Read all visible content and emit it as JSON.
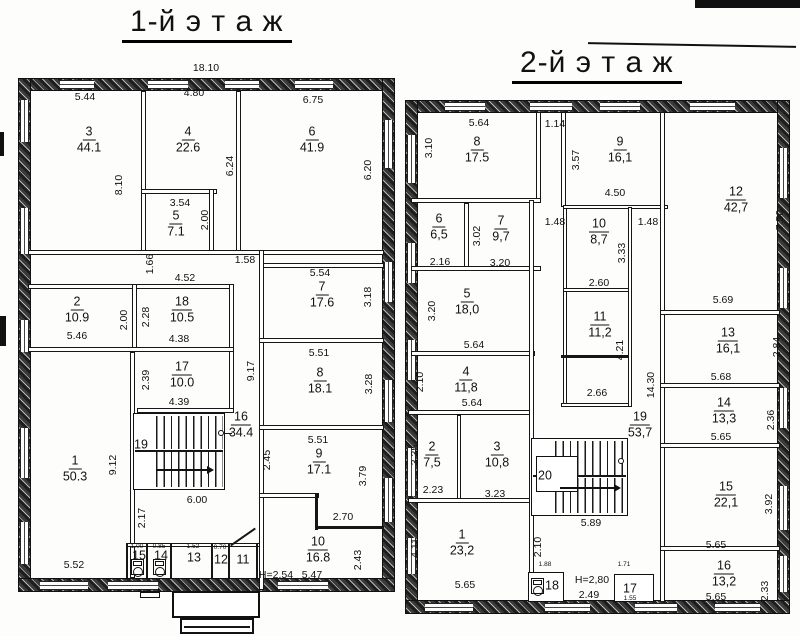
{
  "floor1": {
    "title": "1-й э т а ж",
    "rooms": {
      "r1": {
        "num": "1",
        "area": "50.3"
      },
      "r2": {
        "num": "2",
        "area": "10.9"
      },
      "r3": {
        "num": "3",
        "area": "44.1"
      },
      "r4": {
        "num": "4",
        "area": "22.6"
      },
      "r5": {
        "num": "5",
        "area": "7.1"
      },
      "r6": {
        "num": "6",
        "area": "41.9"
      },
      "r7": {
        "num": "7",
        "area": "17.6"
      },
      "r8": {
        "num": "8",
        "area": "18.1"
      },
      "r9": {
        "num": "9",
        "area": "17.1"
      },
      "r10": {
        "num": "10",
        "area": "16.8"
      },
      "r11": {
        "num": "11"
      },
      "r12": {
        "num": "12"
      },
      "r13": {
        "num": "13"
      },
      "r14": {
        "num": "14"
      },
      "r15": {
        "num": "15"
      },
      "r16": {
        "num": "16",
        "area": "34.4"
      },
      "r17": {
        "num": "17",
        "area": "10.0"
      },
      "r18": {
        "num": "18",
        "area": "10.5"
      },
      "r19": {
        "num": "19"
      }
    },
    "dims": {
      "total": "18.10",
      "a544": "5.44",
      "a480": "4.80",
      "a675": "6.75",
      "a810": "8.10",
      "a624": "6.24",
      "a620": "6.20",
      "a354": "3.54",
      "a200a": "2.00",
      "a166": "1.66",
      "a452": "4.52",
      "a158": "1.58",
      "a554": "5.54",
      "a318": "3.18",
      "a200b": "2.00",
      "a546": "5.46",
      "a228": "2.28",
      "a438": "4.38",
      "a239": "2.39",
      "a439": "4.39",
      "a917": "9.17",
      "a245": "2.45",
      "a551a": "5.51",
      "a328": "3.28",
      "a551b": "5.51",
      "a379": "3.79",
      "a912": "9.12",
      "a217": "2.17",
      "a600": "6.00",
      "a270": "2.70",
      "a243": "2.43",
      "a547": "5.47",
      "h": "H=2,54",
      "a552": "5.52",
      "t100": "1.00",
      "t085": "0.85",
      "t152": "1.52",
      "t070": "0.70"
    }
  },
  "floor2": {
    "title": "2-й э т а ж",
    "rooms": {
      "r1": {
        "num": "1",
        "area": "23,2"
      },
      "r2": {
        "num": "2",
        "area": "7,5"
      },
      "r3": {
        "num": "3",
        "area": "10,8"
      },
      "r4": {
        "num": "4",
        "area": "11,8"
      },
      "r5": {
        "num": "5",
        "area": "18,0"
      },
      "r6": {
        "num": "6",
        "area": "6,5"
      },
      "r7": {
        "num": "7",
        "area": "9,7"
      },
      "r8": {
        "num": "8",
        "area": "17.5"
      },
      "r9": {
        "num": "9",
        "area": "16,1"
      },
      "r10": {
        "num": "10",
        "area": "8,7"
      },
      "r11": {
        "num": "11",
        "area": "11,2"
      },
      "r12": {
        "num": "12",
        "area": "42,7"
      },
      "r13": {
        "num": "13",
        "area": "16,1"
      },
      "r14": {
        "num": "14",
        "area": "13,3"
      },
      "r15": {
        "num": "15",
        "area": "22,1"
      },
      "r16": {
        "num": "16",
        "area": "13,2"
      },
      "r17": {
        "num": "17"
      },
      "r18": {
        "num": "18"
      },
      "r19": {
        "num": "19",
        "area": "53,7"
      },
      "r20": {
        "num": "20"
      }
    },
    "dims": {
      "a564a": "5.64",
      "a114": "1.14",
      "a310": "3.10",
      "a357": "3.57",
      "a450": "4.50",
      "a148a": "1.48",
      "a148b": "1.48",
      "a750": "7.50",
      "a216": "2.16",
      "a302": "3.02",
      "a320a": "3.20",
      "a333": "3.33",
      "a260": "2.60",
      "a320b": "3.20",
      "a564b": "5.64",
      "a421": "4.21",
      "a266": "2.66",
      "a210a": "2.10",
      "a564c": "5.64",
      "a335": "3.35",
      "a223": "2.23",
      "a323": "3.23",
      "a411": "4.11",
      "a565a": "5.65",
      "a210b": "2.10",
      "a589": "5.89",
      "a1430": "14.30",
      "a569": "5.69",
      "a568": "5.68",
      "a284": "2.84",
      "a565b": "5.65",
      "a236": "2.36",
      "a392": "3.92",
      "a565c": "5.65",
      "a565d": "5.65",
      "a233": "2.33",
      "t188": "1.88",
      "t171": "1.71",
      "t155": "1.55",
      "h": "H=2,80",
      "a249": "2.49"
    }
  }
}
